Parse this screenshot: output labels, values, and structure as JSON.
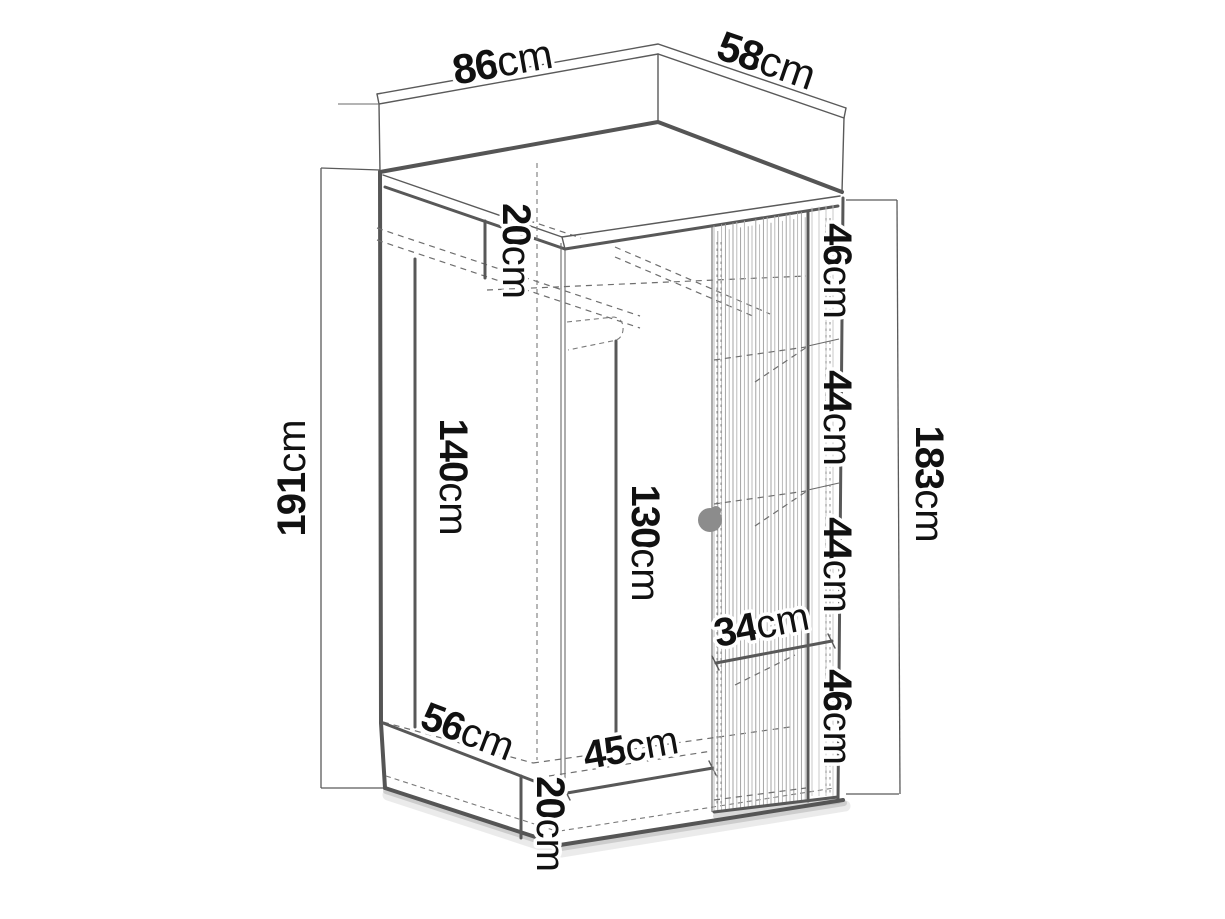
{
  "figure": {
    "kind": "furniture-dimension-diagram",
    "subject": "corner wardrobe isometric drawing with dimensions",
    "unit": "cm",
    "background": "#ffffff",
    "line_color": "#555555",
    "text_color": "#111111",
    "knob_color": "#8c8c8c"
  },
  "dimensions": {
    "top_left_width": {
      "value": "86",
      "unit": "cm",
      "meaning": "top panel left edge width"
    },
    "top_right_width": {
      "value": "58",
      "unit": "cm",
      "meaning": "top panel right edge width"
    },
    "total_height_left": {
      "value": "191",
      "unit": "cm",
      "meaning": "overall height"
    },
    "interior_height_right": {
      "value": "183",
      "unit": "cm",
      "meaning": "interior height right section"
    },
    "top_shelf_gap": {
      "value": "20",
      "unit": "cm",
      "meaning": "top compartment height"
    },
    "hanging_space_height": {
      "value": "140",
      "unit": "cm",
      "meaning": "hanging space height"
    },
    "rail_height": {
      "value": "130",
      "unit": "cm",
      "meaning": "rail to floor height"
    },
    "shelf_gap_1": {
      "value": "46",
      "unit": "cm",
      "meaning": "shelf spacing 1 (top)"
    },
    "shelf_gap_2": {
      "value": "44",
      "unit": "cm",
      "meaning": "shelf spacing 2"
    },
    "shelf_gap_3": {
      "value": "44",
      "unit": "cm",
      "meaning": "shelf spacing 3"
    },
    "shelf_gap_4": {
      "value": "46",
      "unit": "cm",
      "meaning": "shelf spacing 4 (bottom)"
    },
    "shelf_width": {
      "value": "34",
      "unit": "cm",
      "meaning": "shelf width"
    },
    "floor_left_width": {
      "value": "56",
      "unit": "cm",
      "meaning": "left section floor width"
    },
    "floor_right_width": {
      "value": "45",
      "unit": "cm",
      "meaning": "right section floor width"
    },
    "plinth_height": {
      "value": "20",
      "unit": "cm",
      "meaning": "plinth height"
    }
  }
}
